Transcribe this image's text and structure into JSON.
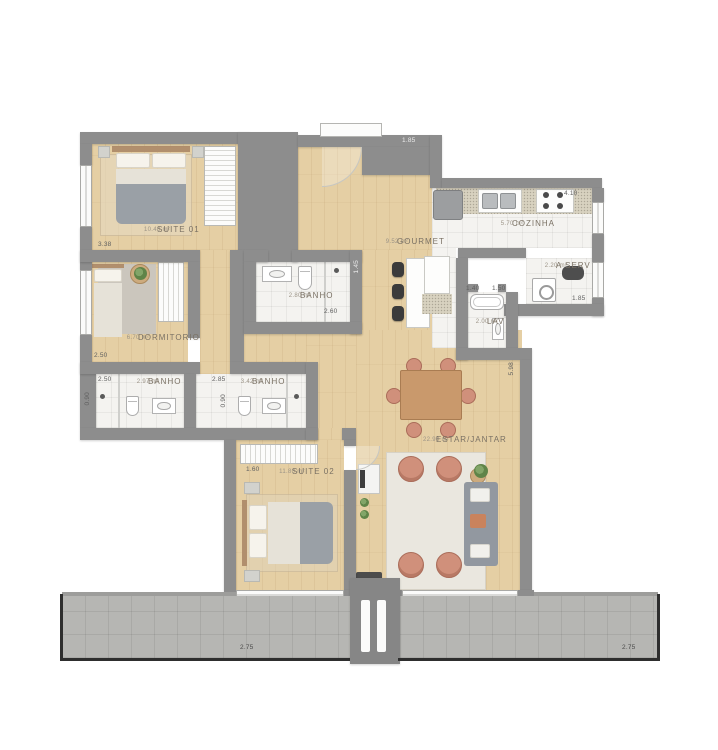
{
  "plan_title": "apartment-floor-plan",
  "rooms": {
    "suite01": {
      "name": "SUITE 01",
      "area": "10.40 m²"
    },
    "dormitorio": {
      "name": "DORMITORIO",
      "area": "6.70 m²"
    },
    "banho_top": {
      "name": "BANHO",
      "area": "2.80 m²"
    },
    "gourmet": {
      "name": "GOURMET",
      "area": "9.52 m²"
    },
    "cozinha": {
      "name": "COZINHA",
      "area": "5.70 m²"
    },
    "aserv": {
      "name": "A SERV",
      "area": "2.20 m²"
    },
    "lav": {
      "name": "LAV",
      "area": "2.00 m²"
    },
    "estar": {
      "name": "ESTAR/JANTAR",
      "area": "22.90 m²"
    },
    "banho1": {
      "name": "BANHO",
      "area": "2.97 m²"
    },
    "banho2": {
      "name": "BANHO",
      "area": "3.42 m²"
    },
    "suite02": {
      "name": "SUITE 02",
      "area": "11.80 m²"
    }
  },
  "dims": [
    "1.85",
    "4.10",
    "1.85",
    "3.38",
    "2.50",
    "2.50",
    "0.90",
    "2.85",
    "0.90",
    "2.60",
    "1.45",
    "1.40",
    "1.50",
    "5.98",
    "1.60",
    "2.75",
    "2.75"
  ],
  "colors": {
    "wall": "#8d8d8d",
    "wood_floor": "#e5cfa4",
    "tile_floor": "#f4f3f0",
    "balcony_floor": "#b6b6b3",
    "accent_chair": "#d0907b",
    "sofa": "#9298a0",
    "label_text": "#7a7164"
  }
}
